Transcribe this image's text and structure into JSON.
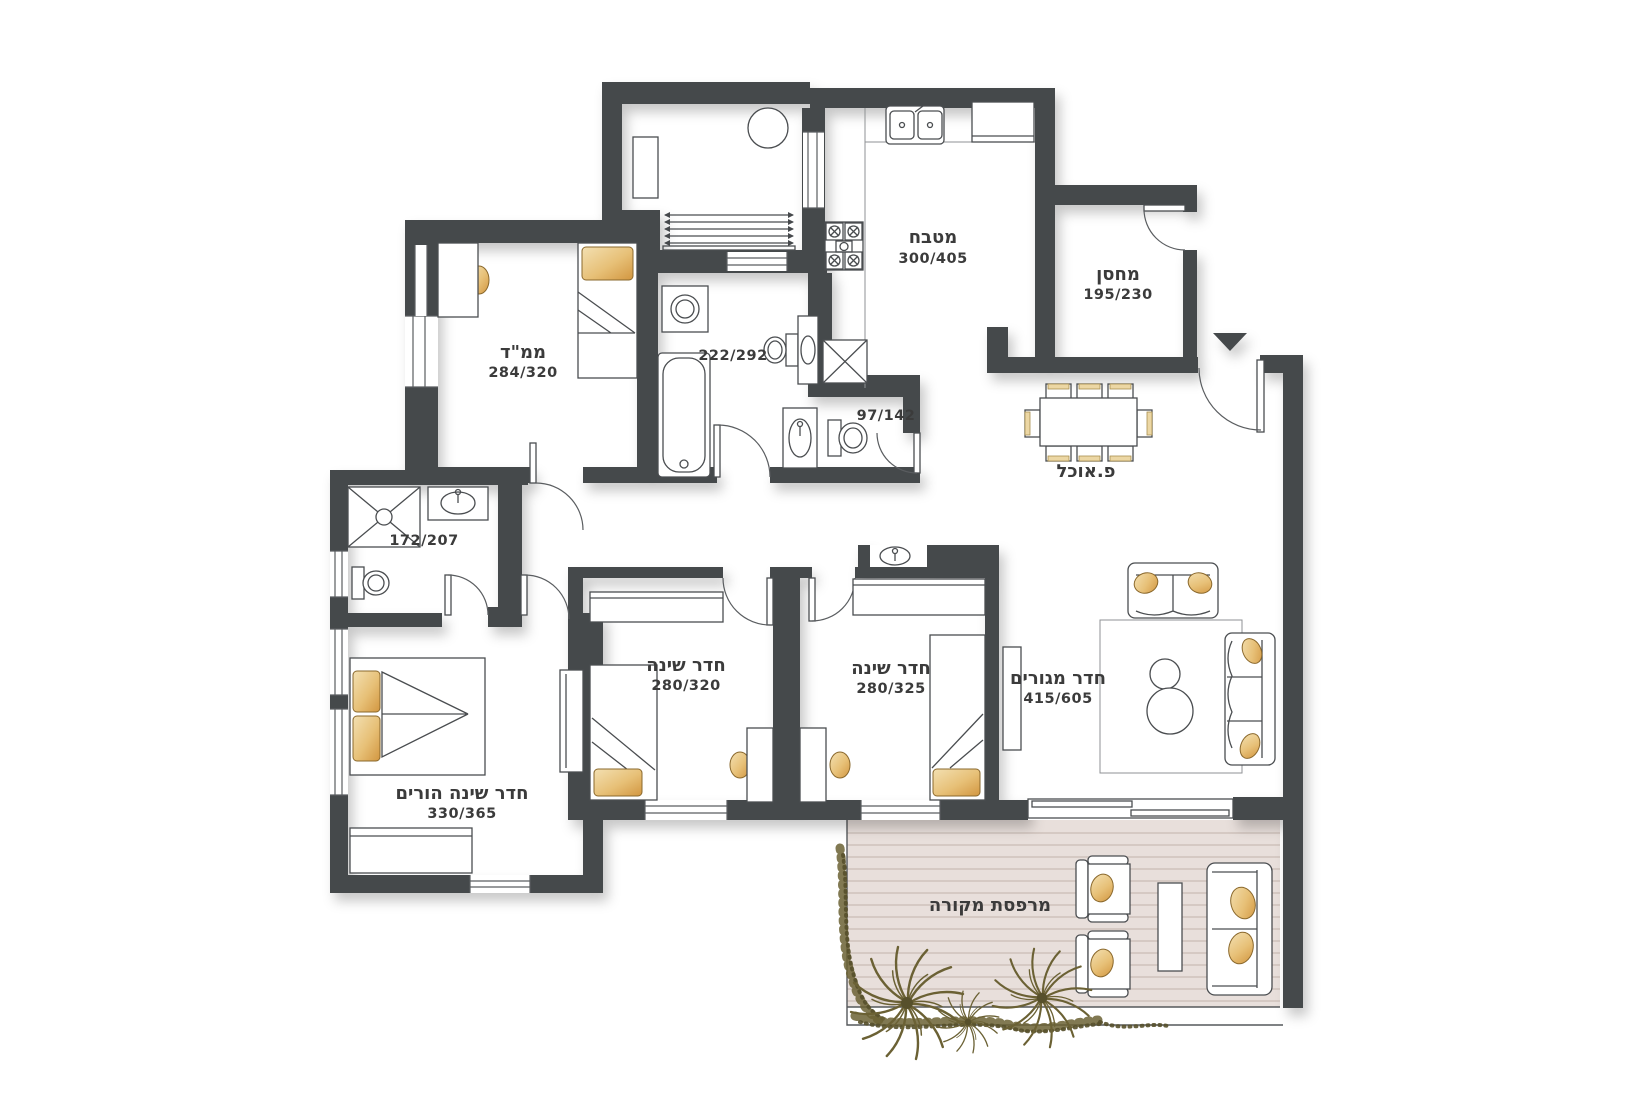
{
  "rooms": {
    "kitchen": {
      "name": "מטבח",
      "size": "300/405"
    },
    "storage": {
      "name": "מחסן",
      "size": "195/230"
    },
    "safe_room": {
      "name": "ממ\"ד",
      "size": "284/320"
    },
    "bathroom": {
      "size": "222/292"
    },
    "wc": {
      "size": "97/142"
    },
    "shower_room": {
      "size": "172/207"
    },
    "dining": {
      "name": "פ.אוכל"
    },
    "master_bedroom": {
      "name": "חדר שינה הורים",
      "size": "330/365"
    },
    "bedroom1": {
      "name": "חדר שינה",
      "size": "280/320"
    },
    "bedroom2": {
      "name": "חדר שינה",
      "size": "280/325"
    },
    "living_room": {
      "name": "חדר מגורים",
      "size": "415/605"
    },
    "balcony": {
      "name": "מרפסת מקורה"
    }
  },
  "colors": {
    "wall": "#45484b",
    "furniture_line": "#4a4d50",
    "pillow_accent": "#d79f42",
    "deck": "#e8dfdb",
    "deck_stripe": "#d5c9c3",
    "plant": "#6b6134",
    "text": "#3b3b3b"
  }
}
